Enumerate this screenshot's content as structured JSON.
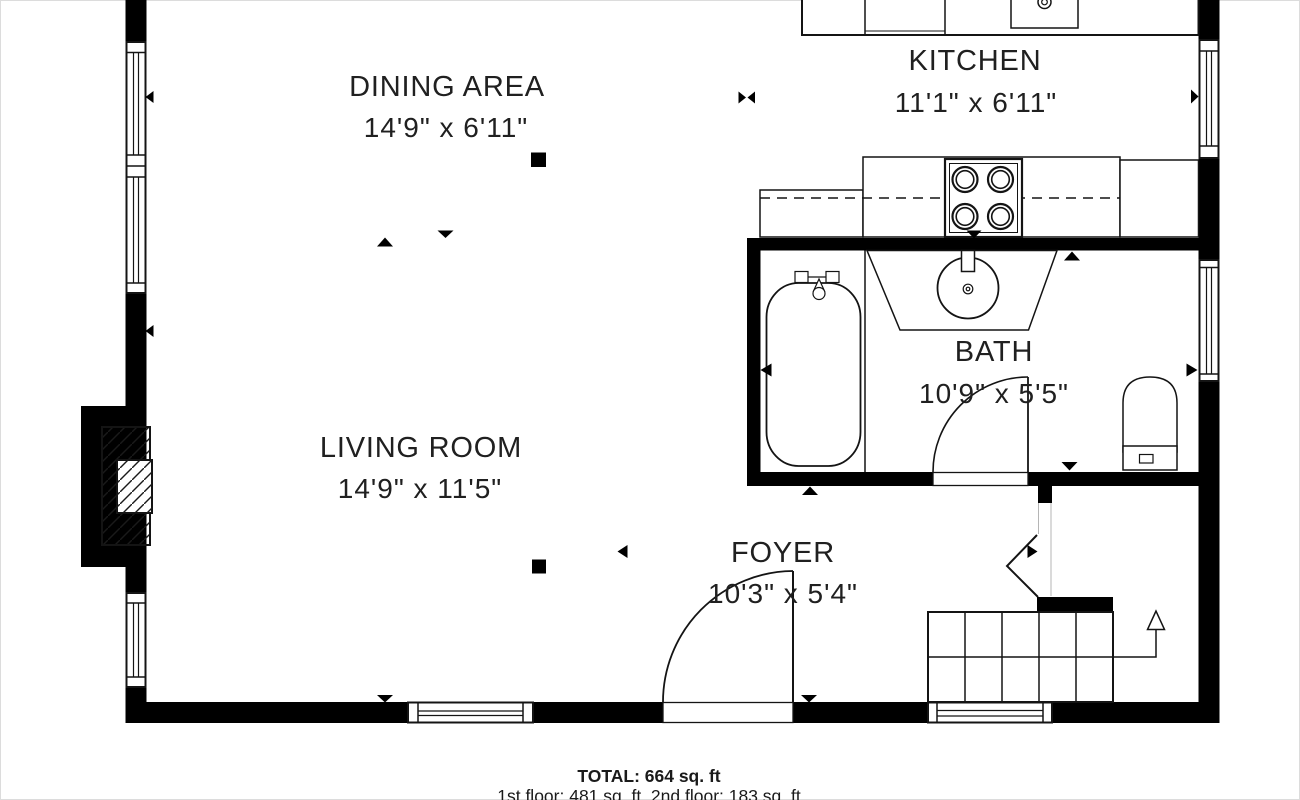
{
  "rooms": [
    {
      "name": "DINING AREA",
      "dims": "14'9\" x 6'11\""
    },
    {
      "name": "KITCHEN",
      "dims": "11'1\" x 6'11\""
    },
    {
      "name": "LIVING ROOM",
      "dims": "14'9\" x 11'5\""
    },
    {
      "name": "BATH",
      "dims": "10'9\" x 5'5\""
    },
    {
      "name": "FOYER",
      "dims": "10'3\" x 5'4\""
    }
  ],
  "footer": {
    "total": "TOTAL: 664 sq. ft",
    "floors": "1st floor: 481 sq. ft, 2nd floor: 183 sq. ft"
  },
  "stairs": {
    "direction": "up"
  },
  "colors": {
    "walls": "#000000",
    "lines": "#141414",
    "text": "#202020",
    "background": "#ffffff"
  }
}
